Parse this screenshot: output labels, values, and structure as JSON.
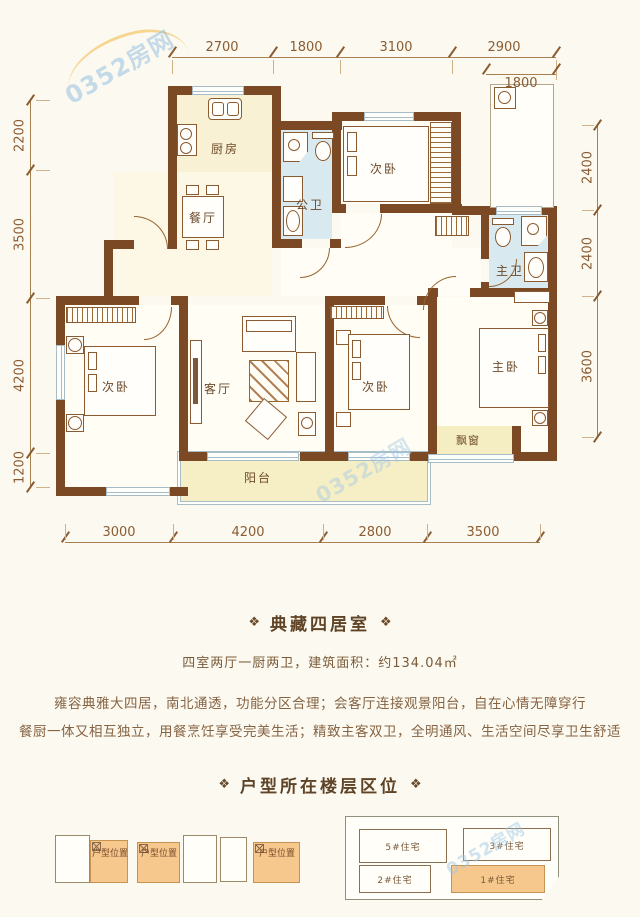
{
  "watermark": "0352房网",
  "plan": {
    "dims_top": [
      "2700",
      "1800",
      "3100",
      "2900"
    ],
    "dim_top_sub": "1800",
    "dims_left": [
      "2200",
      "3500",
      "4200",
      "1200"
    ],
    "dims_right": [
      "2400",
      "2400",
      "3600"
    ],
    "dims_bottom": [
      "3000",
      "4200",
      "2800",
      "3500"
    ],
    "rooms": {
      "kitchen": "厨房",
      "dining": "餐厅",
      "public_bath": "公卫",
      "bedroom_top": "次卧",
      "master_bath": "主卫",
      "bedroom_left": "次卧",
      "living": "客厅",
      "bedroom_mid": "次卧",
      "master": "主卧",
      "bay_window": "飘窗",
      "balcony": "阳台"
    }
  },
  "section1": {
    "ornament": "❖",
    "title": "典藏四居室",
    "subtitle": "四室两厅一厨两卫，建筑面积：约134.04㎡",
    "para1": "雍容典雅大四居，南北通透，功能分区合理；会客厅连接观景阳台，自在心情无障穿行",
    "para2": "餐厨一体又相互独立，用餐烹饪享受完美生活；精致主客双卫，全明通风、生活空间尽享卫生舒适"
  },
  "section2": {
    "ornament": "❖",
    "title": "户型所在楼层区位",
    "unit_label": "户型位置",
    "buildings": [
      "5#住宅",
      "3#住宅",
      "2#住宅",
      "1#住宅"
    ]
  }
}
